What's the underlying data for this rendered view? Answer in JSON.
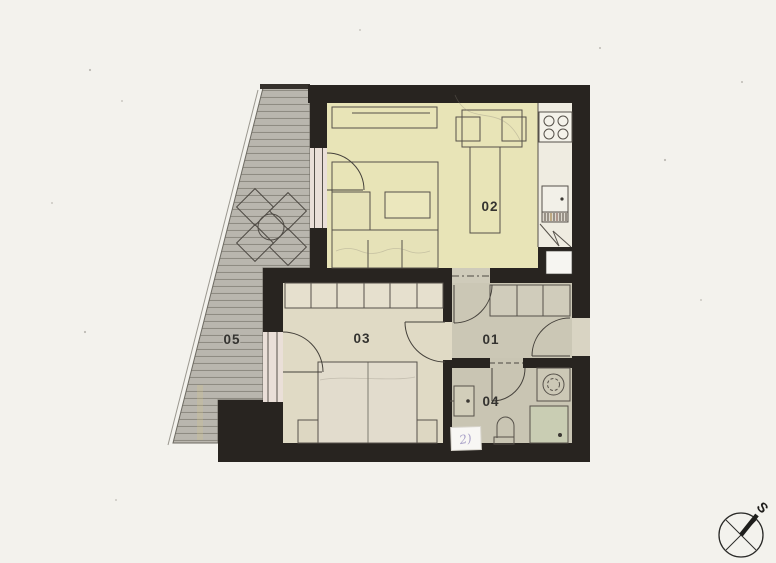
{
  "rooms": {
    "hall": {
      "label": "01"
    },
    "living": {
      "label": "02"
    },
    "bedroom": {
      "label": "03"
    },
    "bath": {
      "label": "04"
    },
    "terrace": {
      "label": "05"
    }
  },
  "compass": {
    "label": "S"
  },
  "note": {
    "text": "2)"
  },
  "icons": {
    "stove": "4-burner-cooktop",
    "kitchen-sink": "unit-square-with-knob",
    "shaft": "white-square-in-wall",
    "break-symbol": "zigzag-lines",
    "dining-table": "table-with-two-chairs",
    "sideboard": "long-low-cabinet",
    "sofa": "corner-sofa-with-rug",
    "coffee-table": "small-rectangle",
    "wardrobe": "segmented-closet",
    "bed": "double-bed-with-nightstands",
    "washbasin": "rect-with-knob",
    "toilet": "wc-bowl",
    "washing-machine": "square-with-drum-circle",
    "shower": "square-with-drain-dot",
    "terrace-set": "four-diamond-chairs-round-table",
    "compass": "circle-cross-north-needle"
  },
  "theme": {
    "paper": "#f3f2ed",
    "wall": "#282420",
    "floor-living": "#e8e4b7",
    "floor-bedroom": "#e0dac5",
    "floor-hall": "#cbc7b5",
    "floor-bath": "#c9c5b3",
    "kitchen": "#efece1",
    "terrace": "#b9b6ae",
    "terrace-line": "#8e8b82",
    "window": "#eadfd8",
    "shower": "#c9cdb3",
    "label": "#343330",
    "ink": "#8d82b8"
  }
}
